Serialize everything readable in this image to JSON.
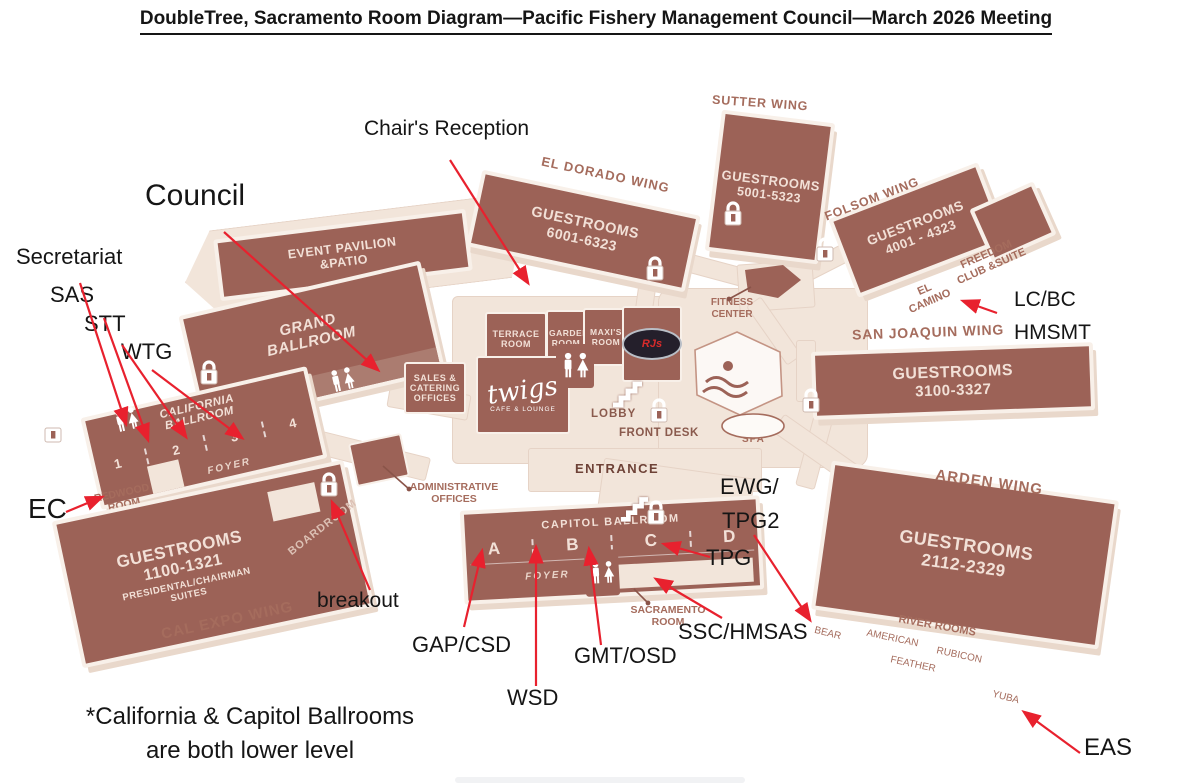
{
  "title": "DoubleTree, Sacramento Room Diagram—Pacific Fishery Management Council—March 2026 Meeting",
  "footnote": {
    "line1": "*California & Capitol Ballrooms",
    "line2": "are both lower level"
  },
  "callouts": {
    "chairs_reception": "Chair's Reception",
    "council": "Council",
    "secretariat": "Secretariat",
    "sas": "SAS",
    "stt": "STT",
    "wtg": "WTG",
    "ec": "EC",
    "breakout": "breakout",
    "gap_csd": "GAP/CSD",
    "wsd": "WSD",
    "gmt_osd": "GMT/OSD",
    "ssc_hmsas": "SSC/HMSAS",
    "tpg": "TPG",
    "ewg_line1": "EWG/",
    "ewg_line2": "TPG2",
    "lc_bc": "LC/BC",
    "hmsmt": "HMSMT",
    "eas": "EAS"
  },
  "wings": {
    "sutter": {
      "name": "SUTTER WING",
      "guestrooms": "GUESTROOMS",
      "range": "5001-5323"
    },
    "el_dorado": {
      "name": "EL DORADO WING",
      "guestrooms": "GUESTROOMS",
      "range": "6001-6323"
    },
    "folsom": {
      "name": "FOLSOM WING",
      "guestrooms": "GUESTROOMS",
      "range": "4001 - 4323"
    },
    "san_joaquin": {
      "name": "SAN JOAQUIN WING",
      "guestrooms": "GUESTROOMS",
      "range": "3100-3327"
    },
    "arden": {
      "name": "ARDEN WING",
      "guestrooms": "GUESTROOMS",
      "range": "2112-2329"
    },
    "cal_expo": {
      "name": "CAL EXPO WING",
      "guestrooms": "GUESTROOMS",
      "range": "1100-1321",
      "suites_line1": "PRESIDENTAL/CHAIRMAN",
      "suites_line2": "SUITES"
    }
  },
  "labels": {
    "freedom_line1": "FREEDOM",
    "freedom_line2": "CLUB &SUITE",
    "el_camino_line1": "EL",
    "el_camino_line2": "CAMINO"
  },
  "rooms": {
    "event_pavilion": "EVENT PAVILION &PATIO",
    "grand_ballroom": "GRAND BALLROOM",
    "california_ballroom": "CALIFORNIA BALLROOM",
    "ca_sections": [
      "1",
      "2",
      "3",
      "4"
    ],
    "capitol_ballroom": "CAPITOL BALLROOM",
    "cap_sections": [
      "A",
      "B",
      "C",
      "D"
    ],
    "foyer": "FOYER",
    "terrace": "TERRACE ROOM",
    "garden": "GARDEN ROOM",
    "maxis": "MAXI'S ROOM",
    "sales": "SALES & CATERING OFFICES",
    "twigs": "twigs",
    "twigs_sub": "CAFE & LOUNGE",
    "rjs": "RJs",
    "lobby": "LOBBY",
    "front_desk": "FRONT DESK",
    "entrance": "ENTRANCE",
    "admin_line1": "ADMINISTRATIVE",
    "admin_line2": "OFFICES",
    "boardroom": "BOARDROOM",
    "redwood_line1": "REDWOOD",
    "redwood_line2": "ROOM",
    "sacramento_line1": "SACRAMENTO",
    "sacramento_line2": "ROOM",
    "fitness_line1": "FITNESS",
    "fitness_line2": "CENTER",
    "spa": "SPA"
  },
  "river_rooms": {
    "title": "RIVER ROOMS",
    "bear": "BEAR",
    "american": "AMERICAN",
    "rubicon": "RUBICON",
    "feather": "FEATHER",
    "yuba": "YUBA"
  },
  "colors": {
    "building": "#9c6257",
    "ground": "#f2e5da",
    "label_rose": "#a56c5d",
    "pale_text": "#f2e0d7",
    "arrow_red": "#e8212e",
    "title_text": "#151515"
  }
}
